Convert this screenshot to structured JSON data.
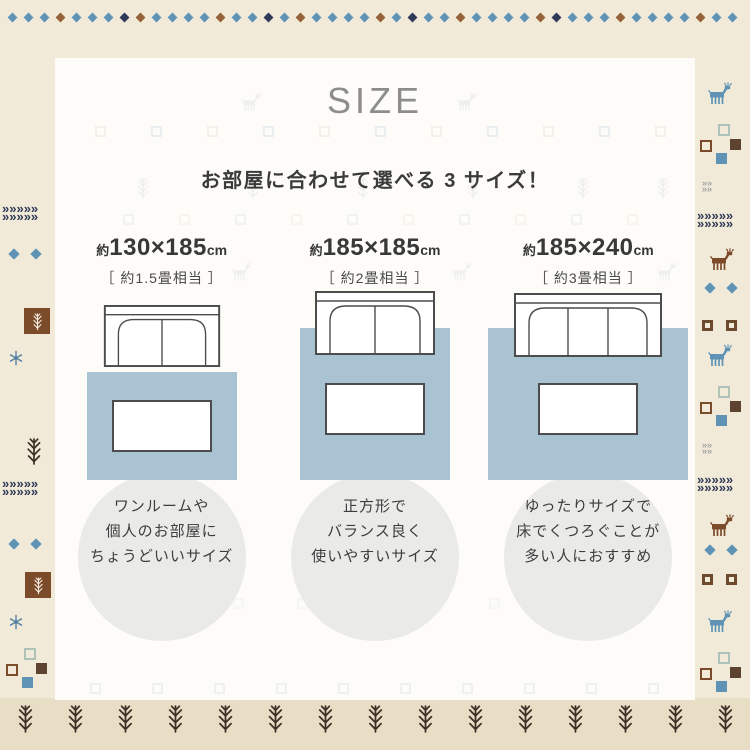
{
  "title": "SIZE",
  "subtitle": "お部屋に合わせて選べる 3 サイズ！",
  "sizes": [
    {
      "approx": "約",
      "dimensions": "130×185",
      "unit": "cm",
      "tatami": "［ 約1.5畳相当 ］",
      "caption_lines": [
        "ワンルームや",
        "個人のお部屋に",
        "ちょうどいいサイズ"
      ]
    },
    {
      "approx": "約",
      "dimensions": "185×185",
      "unit": "cm",
      "tatami": "［ 約2畳相当 ］",
      "caption_lines": [
        "正方形で",
        "バランス良く",
        "使いやすいサイズ"
      ]
    },
    {
      "approx": "約",
      "dimensions": "185×240",
      "unit": "cm",
      "tatami": "［ 約3畳相当 ］",
      "caption_lines": [
        "ゆったりサイズで",
        "床でくつろぐことが",
        "多い人におすすめ"
      ]
    }
  ],
  "colors": {
    "bg-cream": "#f1ead9",
    "bg-band": "#e8ddc5",
    "panel": "#fdfcf8",
    "rug-blue": "#a9c3d2",
    "circle-gray": "#eaeae8",
    "title-gray": "#8d8d8d",
    "text-dark": "#3b3b3b",
    "motif-navy": "#2f3a58",
    "motif-blue": "#5f93b5",
    "motif-brown": "#7c4b2a",
    "motif-tree": "#3e3026"
  },
  "icons": {
    "deer-icon": "stylized gabbeh deer motif",
    "tree-twig-icon": "fir twig motif",
    "diamond-icon": "small rotated square",
    "chevron-arrows-icon": "dotted navy chevrons",
    "snowflake-icon": "small blue plant/star",
    "square-motif-icon": "small pattern squares",
    "sofa-icon": "top-view sofa outline",
    "rug-icon": "blue rug rectangle",
    "table-icon": "white low table rectangle"
  },
  "decor": {
    "top_diamond_count": 46,
    "bottom_tree_count": 15
  }
}
